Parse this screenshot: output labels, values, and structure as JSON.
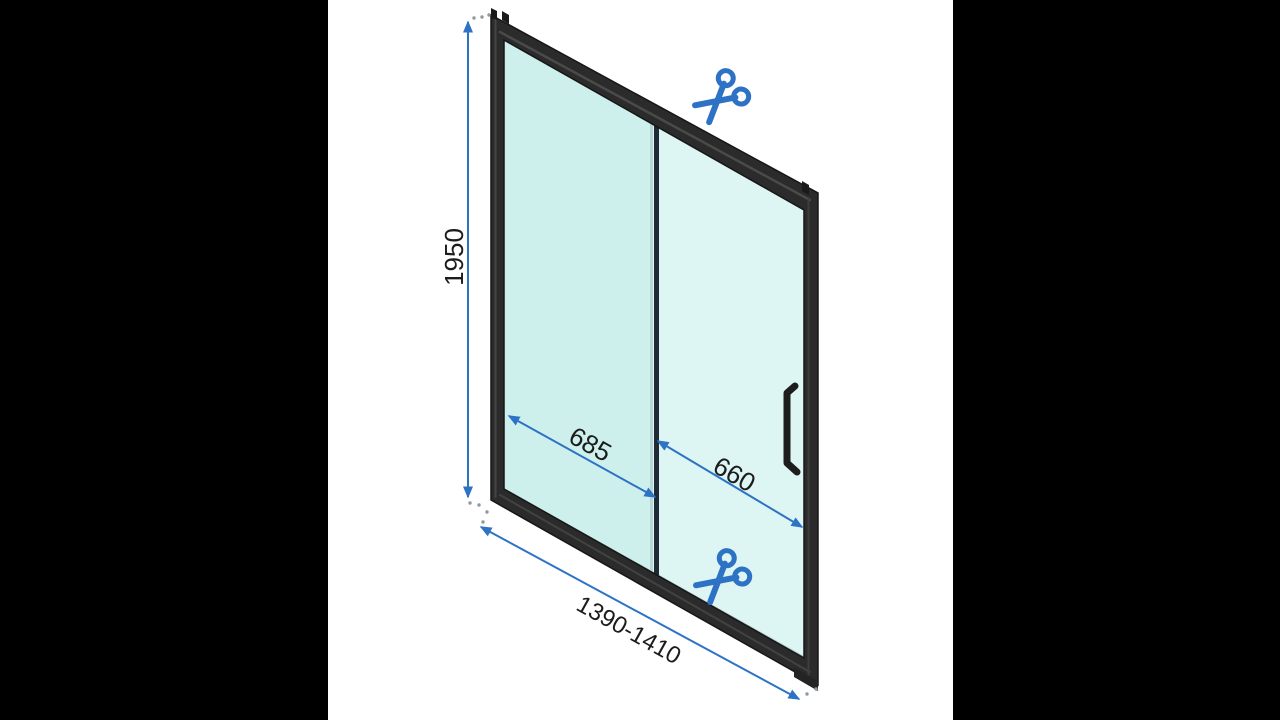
{
  "scene": {
    "type": "product-dimension-diagram",
    "subject": "sliding shower door with cuttable adjustable profiles",
    "background": "#ffffff",
    "pillarbox": "#000000"
  },
  "labels": {
    "height_mm": "1950",
    "overall_width_range_mm": "1390-1410",
    "left_section_width_mm": "685",
    "sliding_section_width_mm": "660"
  },
  "colors": {
    "dimension_blue": "#2d72c5",
    "frame": "#2b2b2b",
    "frame_edge": "#161616",
    "glass_left": "#cdf0ed",
    "glass_right": "#def6f3",
    "divider_light": "#b7d8d6",
    "divider_dark": "#1e2a36",
    "text": "#1c1c1c",
    "extension_dots": "#8d9aa6"
  },
  "icons": {
    "scissors_top": "scissors-icon",
    "scissors_bottom": "scissors-icon"
  }
}
